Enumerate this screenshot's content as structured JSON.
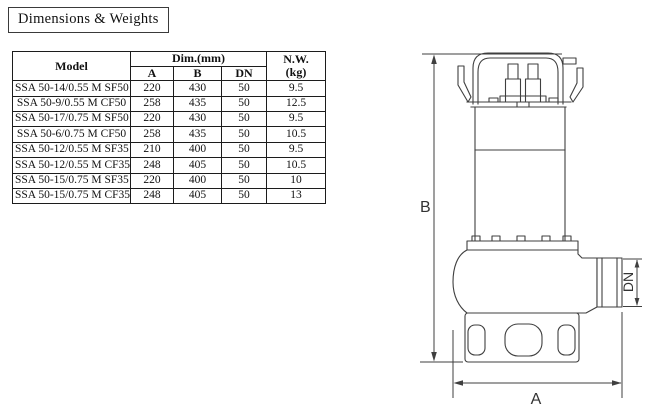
{
  "page": {
    "title": "Dimensions & Weights"
  },
  "table": {
    "headers": {
      "model": "Model",
      "dim_group": "Dim.(mm)",
      "a": "A",
      "b": "B",
      "dn": "DN",
      "nw": "N.W.",
      "nw_unit": "(kg)"
    },
    "rows": [
      {
        "model": "SSA  50-14/0.55 M SF50",
        "a": "220",
        "b": "430",
        "dn": "50",
        "nw": "9.5"
      },
      {
        "model": "SSA 50-9/0.55 M CF50",
        "a": "258",
        "b": "435",
        "dn": "50",
        "nw": "12.5"
      },
      {
        "model": "SSA 50-17/0.75 M SF50",
        "a": "220",
        "b": "430",
        "dn": "50",
        "nw": "9.5"
      },
      {
        "model": "SSA 50-6/0.75 M CF50",
        "a": "258",
        "b": "435",
        "dn": "50",
        "nw": "10.5"
      },
      {
        "model": "SSA 50-12/0.55 M SF35",
        "a": "210",
        "b": "400",
        "dn": "50",
        "nw": "9.5"
      },
      {
        "model": "SSA 50-12/0.55 M CF35",
        "a": "248",
        "b": "405",
        "dn": "50",
        "nw": "10.5"
      },
      {
        "model": "SSA 50-15/0.75 M SF35",
        "a": "220",
        "b": "400",
        "dn": "50",
        "nw": "10"
      },
      {
        "model": "SSA 50-15/0.75 M CF35",
        "a": "248",
        "b": "405",
        "dn": "50",
        "nw": "13"
      }
    ]
  },
  "drawing": {
    "labels": {
      "height": "B",
      "length": "A",
      "port": "DN"
    },
    "line_color": "#3f3f3f"
  }
}
